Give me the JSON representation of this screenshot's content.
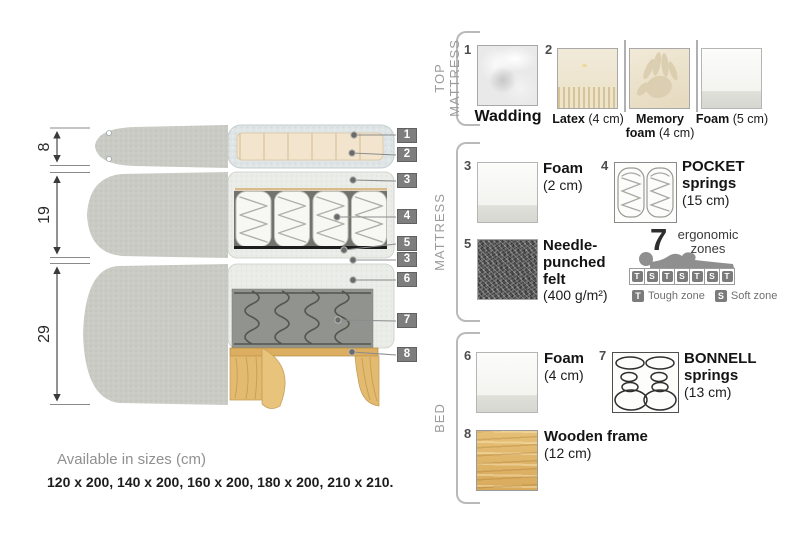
{
  "diagram": {
    "dims": [
      {
        "value": "8"
      },
      {
        "value": "19"
      },
      {
        "value": "29"
      }
    ],
    "callouts": [
      {
        "num": "1"
      },
      {
        "num": "2"
      },
      {
        "num": "3"
      },
      {
        "num": "4"
      },
      {
        "num": "5"
      },
      {
        "num": "3"
      },
      {
        "num": "6"
      },
      {
        "num": "7"
      },
      {
        "num": "8"
      }
    ]
  },
  "legend": {
    "top_mattress": {
      "label": "TOP MATTRESS",
      "item1": {
        "num": "1",
        "name": "Wadding"
      },
      "item2": {
        "num": "2",
        "name": "Latex",
        "size": "(4 cm)"
      },
      "item2b": {
        "name": "Memory foam",
        "size": "(4 cm)"
      },
      "item2c": {
        "name": "Foam",
        "size": "(5 cm)"
      }
    },
    "mattress": {
      "label": "MATTRESS",
      "item3": {
        "num": "3",
        "name": "Foam",
        "size": "(2 cm)"
      },
      "item4": {
        "num": "4",
        "name": "POCKET springs",
        "size": "(15 cm)"
      },
      "item5": {
        "num": "5",
        "name": "Needle-punched felt",
        "size": "(400 g/m²)"
      },
      "ergonomic": {
        "count": "7",
        "word1": "ergonomic",
        "word2": "zones",
        "zones": [
          "T",
          "S",
          "T",
          "S",
          "T",
          "S",
          "T"
        ],
        "tough_letter": "T",
        "tough_label": "Tough zone",
        "soft_letter": "S",
        "soft_label": "Soft zone"
      }
    },
    "bed": {
      "label": "BED",
      "item6": {
        "num": "6",
        "name": "Foam",
        "size": "(4 cm)"
      },
      "item7": {
        "num": "7",
        "name": "BONNELL springs",
        "size": "(13 cm)"
      },
      "item8": {
        "num": "8",
        "name": "Wooden frame",
        "size": "(12 cm)"
      }
    }
  },
  "footer": {
    "title": "Available in sizes (cm)",
    "sizes": "120 x 200, 140 x 200, 160 x 200, 180 x 200, 210 x 210."
  }
}
